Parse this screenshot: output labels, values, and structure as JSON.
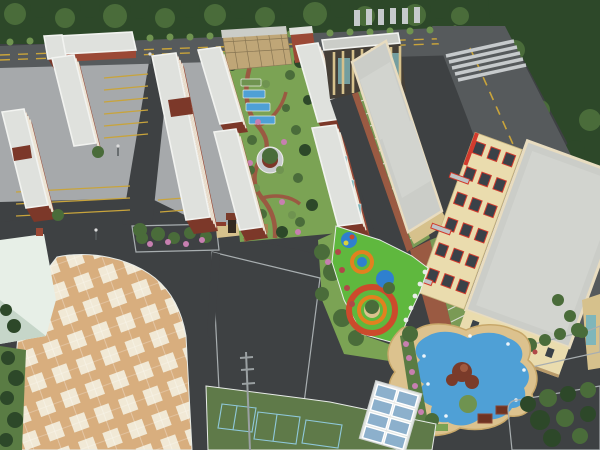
{
  "image": {
    "type": "3d-aerial-architectural-rendering",
    "subject": "Bird's-eye masterplan rendering of a school / residential campus with apartment slabs, landscaped courtyard, plaza, playground and pond",
    "visible_text": "none"
  },
  "palette": {
    "asphaltDark": "#3e4143",
    "asphaltRoad": "#565a5c",
    "roadLine": "#c9a43b",
    "zebra": "#c6cacc",
    "pavement": "#a6a9ab",
    "padConcrete": "#c9ccc8",
    "parkingStripe": "#c8a43c",
    "treeDark": "#2d4829",
    "treeMid": "#4a6c3a",
    "treeLight": "#6f9350",
    "grass": "#7ba354",
    "grassDark": "#5a7c44",
    "brick": "#9b4936",
    "brickDark": "#7c3829",
    "windowBand": "#ece4d4",
    "roofLight": "#dfe1dd",
    "roofGray": "#cbcdc8",
    "roofInner": "#d2d4cf",
    "cream": "#eadcae",
    "creamDark": "#d6c18c",
    "redAccent": "#d23b2e",
    "tealGlass": "#7fb6ba",
    "glassBlue": "#8cb0cc",
    "shelterFrame": "#e9ecec",
    "plazaTan": "#d8ae7e",
    "plazaCream": "#f1e9d6",
    "courtGreen": "#5f7a49",
    "courtLine": "#8fc8da",
    "playGreen": "#5fb83e",
    "playOrange": "#e2811f",
    "playRed": "#cc4a2c",
    "playBlue": "#2f80cf",
    "playYellow": "#d8d23c",
    "pondBlue": "#4fa0d6",
    "stoneTan": "#dcc28e",
    "pinkBloom": "#c77fb0",
    "redBloom": "#b04848",
    "whiteBuilding": "#e7efe7",
    "whiteShade": "#c6d6c9",
    "tanBuilding": "#bfa677",
    "darkWindow": "#3a4148",
    "pavilionRoof": "#8a3c2c",
    "pathBrick": "#9a5a42",
    "parkingGreen": "#7a9a55",
    "parkingLine": "#d8dcd0",
    "facadeDark": "#453f37",
    "gateDark": "#332a20",
    "rockery": "#7a3b2a",
    "poleGray": "#9aa0a2"
  },
  "regions": [
    {
      "name": "tree-belt-north",
      "label": "Dense tree belt along north perimeter road"
    },
    {
      "name": "north-road",
      "label": "East-west perimeter road with double yellow line"
    },
    {
      "name": "east-road",
      "label": "Diagonal perimeter road with yellow dashed line and crosswalks"
    },
    {
      "name": "apartment-cluster",
      "label": "Red brick apartment slabs with light flat roofs"
    },
    {
      "name": "parking-lanes",
      "label": "Surface parking with yellow bay stripes"
    },
    {
      "name": "central-courtyard",
      "label": "Landscaped courtyard with winding brick paths, planting plots and circular plaza"
    },
    {
      "name": "dormitory-building",
      "label": "Tan dormitory block"
    },
    {
      "name": "colonnade-building",
      "label": "Cream colonnade building with teal curtain glazing"
    },
    {
      "name": "teaching-building",
      "label": "Long cream classroom block with stepped grey roofs"
    },
    {
      "name": "main-building",
      "label": "Large cream building with red-framed window bands"
    },
    {
      "name": "entrance-gate",
      "label": "Campus entrance gate with arched openings"
    },
    {
      "name": "tiled-plaza",
      "label": "Tan and cream chequered plaza with rounded corner"
    },
    {
      "name": "concrete-pad",
      "label": "Light concrete parking pad"
    },
    {
      "name": "white-building",
      "label": "Pale utility building"
    },
    {
      "name": "sports-courts",
      "label": "Green sports courts with light markings"
    },
    {
      "name": "playground",
      "label": "Rubberised playground with coloured concentric circles"
    },
    {
      "name": "pond-island",
      "label": "Water feature island with pond, rockery and flower beds"
    },
    {
      "name": "bike-shelter",
      "label": "Blue glass canopy shelter"
    },
    {
      "name": "tree-bed-southeast",
      "label": "Curbed planting bed with trees"
    },
    {
      "name": "floodlight-pole",
      "label": "Tall floodlight pole"
    }
  ]
}
